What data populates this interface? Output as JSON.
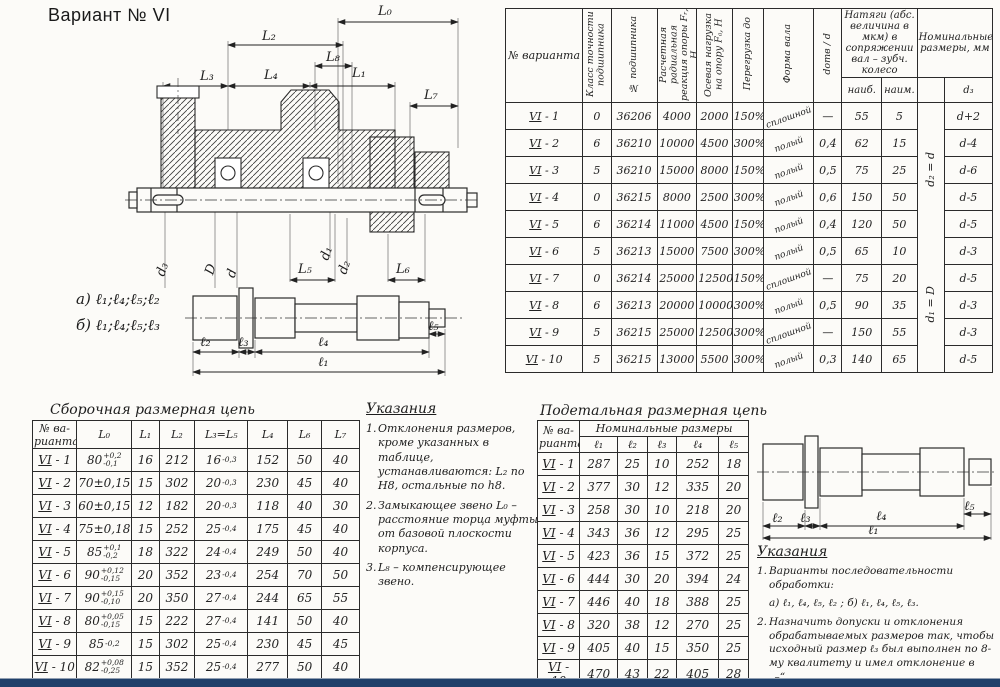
{
  "page": {
    "title": "Вариант № VI"
  },
  "colors": {
    "paper": "#fcfbf8",
    "ink": "#222222",
    "bottom_bar": "#20406a"
  },
  "drawing": {
    "L0": "L₀",
    "L1": "L₁",
    "L2": "L₂",
    "L3": "L₃",
    "L4": "L₄",
    "L5": "L₅",
    "L6": "L₆",
    "L7": "L₇",
    "L8": "L₈",
    "d3": "d₃",
    "D": "D",
    "d": "d",
    "d1": "d₁",
    "d2": "d₂",
    "seq_a": "а) ℓ₁;ℓ₄;ℓ₅;ℓ₂",
    "seq_b": "б) ℓ₁;ℓ₄;ℓ₅;ℓ₃",
    "l1": "ℓ₁",
    "l2": "ℓ₂",
    "l3": "ℓ₃",
    "l4": "ℓ₄",
    "l5": "ℓ₅"
  },
  "bearing_table": {
    "headers": [
      "№ варианта",
      "Класс точности подшипника",
      "№ подшипника",
      "Расчетная радиальная реакция опоры Fᵣ, Н",
      "Осевая нагрузка на опору Fₐ, Н",
      "Перегрузка до",
      "Форма вала",
      "dотв / d",
      "наиб.",
      "наим.",
      "d₃"
    ],
    "group_tight": "Натяги (абс. величина в мкм) в сопряжении вал – зубч. колесо",
    "group_nominal": "Номинальные размеры, мм",
    "d_notes": [
      "d₂ = d",
      "d₁ = D"
    ],
    "rows": [
      [
        "VI-1",
        "0",
        "36206",
        "4000",
        "2000",
        "150%",
        "сплошной",
        "—",
        "55",
        "5",
        "d+2"
      ],
      [
        "VI-2",
        "6",
        "36210",
        "10000",
        "4500",
        "300%",
        "полый",
        "0,4",
        "62",
        "15",
        "d-4"
      ],
      [
        "VI-3",
        "5",
        "36210",
        "15000",
        "8000",
        "150%",
        "полый",
        "0,5",
        "75",
        "25",
        "d-6"
      ],
      [
        "VI-4",
        "0",
        "36215",
        "8000",
        "2500",
        "300%",
        "полый",
        "0,6",
        "150",
        "50",
        "d-5"
      ],
      [
        "VI-5",
        "6",
        "36214",
        "11000",
        "4500",
        "150%",
        "полый",
        "0,4",
        "120",
        "50",
        "d-5"
      ],
      [
        "VI-6",
        "5",
        "36213",
        "15000",
        "7500",
        "300%",
        "полый",
        "0,5",
        "65",
        "10",
        "d-3"
      ],
      [
        "VI-7",
        "0",
        "36214",
        "25000",
        "12500",
        "150%",
        "сплошной",
        "—",
        "75",
        "20",
        "d-5"
      ],
      [
        "VI-8",
        "6",
        "36213",
        "20000",
        "10000",
        "300%",
        "полый",
        "0,5",
        "90",
        "35",
        "d-3"
      ],
      [
        "VI-9",
        "5",
        "36215",
        "25000",
        "12500",
        "300%",
        "сплошной",
        "—",
        "150",
        "55",
        "d-3"
      ],
      [
        "VI-10",
        "5",
        "36215",
        "13000",
        "5500",
        "300%",
        "полый",
        "0,3",
        "140",
        "65",
        "d-5"
      ]
    ]
  },
  "assembly_chain": {
    "title": "Сборочная размерная цепь",
    "headers": [
      "№ ва-рианта",
      "L₀",
      "L₁",
      "L₂",
      "L₃=L₅",
      "L₄",
      "L₆",
      "L₇"
    ],
    "rows": [
      [
        "VI-1",
        "80[+0,2/-0,1]",
        "16",
        "212",
        "16[/-0,3]",
        "152",
        "50",
        "40"
      ],
      [
        "VI-2",
        "70±0,15",
        "15",
        "302",
        "20[/-0,3]",
        "230",
        "45",
        "40"
      ],
      [
        "VI-3",
        "60±0,15",
        "12",
        "182",
        "20[/-0,3]",
        "118",
        "40",
        "30"
      ],
      [
        "VI-4",
        "75±0,18",
        "15",
        "252",
        "25[/-0,4]",
        "175",
        "45",
        "40"
      ],
      [
        "VI-5",
        "85[+0,1/-0,2]",
        "18",
        "322",
        "24[/-0,4]",
        "249",
        "50",
        "40"
      ],
      [
        "VI-6",
        "90[+0,12/-0,15]",
        "20",
        "352",
        "23[/-0,4]",
        "254",
        "70",
        "50"
      ],
      [
        "VI-7",
        "90[+0,15/-0,10]",
        "20",
        "350",
        "27[/-0,4]",
        "244",
        "65",
        "55"
      ],
      [
        "VI-8",
        "80[+0,05/-0,15]",
        "15",
        "222",
        "27[/-0,4]",
        "141",
        "50",
        "40"
      ],
      [
        "VI-9",
        "85[/-0,2]",
        "15",
        "302",
        "25[/-0,4]",
        "230",
        "45",
        "45"
      ],
      [
        "VI-10",
        "82[+0,08/-0,25]",
        "15",
        "352",
        "25[/-0,4]",
        "277",
        "50",
        "40"
      ]
    ]
  },
  "notes_left": {
    "title": "Указания",
    "items": [
      {
        "num": "1.",
        "text": "Отклонения размеров, кроме указанных в таблице, устанавливаются: L₂ по Н8, остальные по h8."
      },
      {
        "num": "2.",
        "text": "Замыкающее звено L₀ – расстояние торца муфты от базовой плоскости корпуса."
      },
      {
        "num": "3.",
        "text": "L₈ – компенсирующее звено."
      }
    ]
  },
  "detail_chain": {
    "title": "Подетальная размерная цепь",
    "variant_header": "№ ва-рианта",
    "group_header": "Номинальные размеры",
    "sub_headers": [
      "ℓ₁",
      "ℓ₂",
      "ℓ₃",
      "ℓ₄",
      "ℓ₅"
    ],
    "rows": [
      [
        "VI-1",
        "287",
        "25",
        "10",
        "252",
        "18"
      ],
      [
        "VI-2",
        "377",
        "30",
        "12",
        "335",
        "20"
      ],
      [
        "VI-3",
        "258",
        "30",
        "10",
        "218",
        "20"
      ],
      [
        "VI-4",
        "343",
        "36",
        "12",
        "295",
        "25"
      ],
      [
        "VI-5",
        "423",
        "36",
        "15",
        "372",
        "25"
      ],
      [
        "VI-6",
        "444",
        "30",
        "20",
        "394",
        "24"
      ],
      [
        "VI-7",
        "446",
        "40",
        "18",
        "388",
        "25"
      ],
      [
        "VI-8",
        "320",
        "38",
        "12",
        "270",
        "25"
      ],
      [
        "VI-9",
        "405",
        "40",
        "15",
        "350",
        "25"
      ],
      [
        "VI-10",
        "470",
        "43",
        "22",
        "405",
        "28"
      ]
    ]
  },
  "notes_right": {
    "title": "Указания",
    "items": [
      {
        "num": "1.",
        "text": "Варианты последовательности обработки:"
      },
      {
        "num": "",
        "text": "а) ℓ₁, ℓ₄, ℓ₅, ℓ₂ ;    б) ℓ₁, ℓ₄, ℓ₅, ℓ₃."
      },
      {
        "num": "2.",
        "text": "Назначить допуски и отклонения обрабатываемых размеров так, чтобы исходный размер ℓ₃ был выполнен по 8-му квалитету и имел отклонение в „–“."
      }
    ]
  }
}
